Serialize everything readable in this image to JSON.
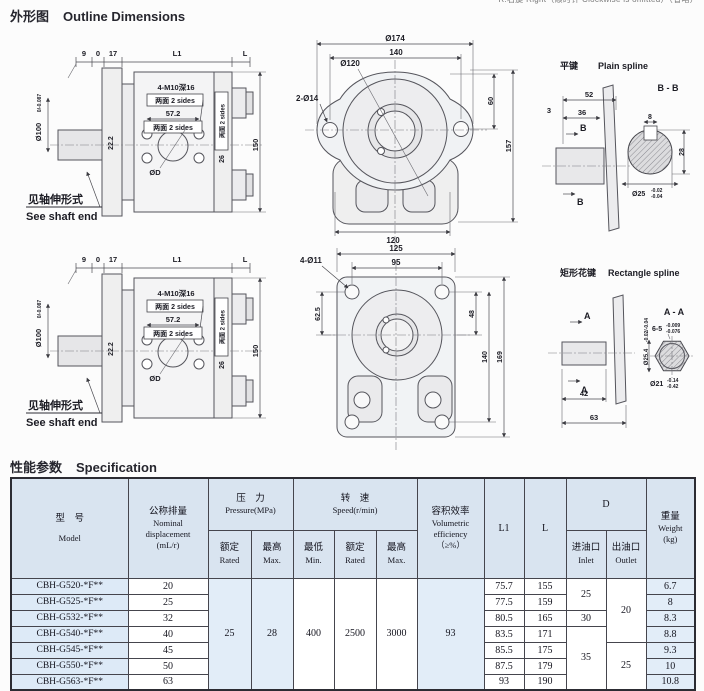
{
  "colors": {
    "page-bg": "#fcfcfc",
    "ink": "#26262e",
    "dim-line": "#4a4a50",
    "table-border": "#45454d",
    "header-bg": "#d9e4f0",
    "cell-blue": "#e2edf8",
    "cell-model": "#ddeaf7",
    "cell-white": "#ffffff"
  },
  "titles": {
    "outline_zh": "外形图",
    "outline_en": "Outline Dimensions",
    "spec_zh": "性能参数",
    "spec_en": "Specification",
    "top_note": "R:右旋 Right（顺时针 Clockwise is omitted）（省略）"
  },
  "side_view": {
    "top_d1": "9",
    "top_d2": "0",
    "top_d3": "17",
    "top_d4": "L1",
    "top_d5": "L",
    "shaft_dia": "Ø100",
    "shaft_tol": "0/-0.087",
    "dim_a": "22.2",
    "tap_note": "4-M10深16",
    "both_sides": "两面 2 sides",
    "dim_b": "57.2",
    "pilot": "ØD",
    "dim_c": "26",
    "dim_d": "150",
    "shaft_note_zh": "见轴伸形式",
    "shaft_note_en": "See shaft end"
  },
  "oval_flange": {
    "dia_outer": "Ø174",
    "dim_140": "140",
    "dia_boss": "Ø120",
    "holes": "2-Ø14",
    "dim_60": "60",
    "dim_157": "157",
    "dim_120": "120"
  },
  "rect_flange": {
    "holes": "4-Ø11",
    "dim_125": "125",
    "dim_95": "95",
    "dim_625": "62.5",
    "dim_48": "48",
    "dim_140": "140",
    "dim_169": "169"
  },
  "plain_spline": {
    "title_zh": "平键",
    "title_en": "Plain spline",
    "section": "B - B",
    "dim_52": "52",
    "dim_3": "3",
    "dim_36": "36",
    "arrow": "B",
    "dim_8": "8",
    "dim_28": "28",
    "dia": "Ø25",
    "tol_u": "-0.02",
    "tol_l": "-0.04"
  },
  "rect_spline": {
    "title_zh": "矩形花键",
    "title_en": "Rectangle spline",
    "section": "A - A",
    "arrow": "A",
    "dim_42": "42",
    "dim_63": "63",
    "spec": "6-5",
    "spec_tol_u": "-0.009",
    "spec_tol_l": "-0.076",
    "dia_major": "Ø25.4",
    "major_tol": "-0.02/-0.04",
    "dia_minor": "Ø21",
    "minor_tol_u": "-0.14",
    "minor_tol_l": "-0.42"
  },
  "spec_table": {
    "header": {
      "model_zh": "型　号",
      "model_en": "Model",
      "disp_zh": "公称排量",
      "disp_en1": "Nominal",
      "disp_en2": "displacement",
      "disp_en3": "(mL/r)",
      "pressure_zh": "压　力",
      "pressure_en": "Pressure(MPa)",
      "speed_zh": "转　速",
      "speed_en": "Speed(r/min)",
      "rated_zh": "额定",
      "rated_en": "Rated",
      "max_zh": "最高",
      "max_en": "Max.",
      "min_zh": "最低",
      "min_en": "Min.",
      "vol_zh": "容积效率",
      "vol_en1": "Volumetric",
      "vol_en2": "efficiency",
      "vol_en3": "（≥%）",
      "l1": "L1",
      "l": "L",
      "d": "D",
      "inlet_zh": "进油口",
      "inlet_en": "Inlet",
      "outlet_zh": "出油口",
      "outlet_en": "Outlet",
      "weight_zh": "重量",
      "weight_en": "Weight",
      "weight_unit": "(kg)"
    },
    "shared": {
      "pressure_rated": "25",
      "pressure_max": "28",
      "speed_min": "400",
      "speed_rated": "2500",
      "speed_max": "3000",
      "vol_eff": "93",
      "inlet_1": "25",
      "inlet_2": "30",
      "inlet_3": "35",
      "outlet_1": "20",
      "outlet_2": "25"
    },
    "rows": [
      {
        "model": "CBH-G520-*F**",
        "disp": "20",
        "l1": "75.7",
        "l": "155",
        "weight": "6.7"
      },
      {
        "model": "CBH-G525-*F**",
        "disp": "25",
        "l1": "77.5",
        "l": "159",
        "weight": "8"
      },
      {
        "model": "CBH-G532-*F**",
        "disp": "32",
        "l1": "80.5",
        "l": "165",
        "weight": "8.3"
      },
      {
        "model": "CBH-G540-*F**",
        "disp": "40",
        "l1": "83.5",
        "l": "171",
        "weight": "8.8"
      },
      {
        "model": "CBH-G545-*F**",
        "disp": "45",
        "l1": "85.5",
        "l": "175",
        "weight": "9.3"
      },
      {
        "model": "CBH-G550-*F**",
        "disp": "50",
        "l1": "87.5",
        "l": "179",
        "weight": "10"
      },
      {
        "model": "CBH-G563-*F**",
        "disp": "63",
        "l1": "93",
        "l": "190",
        "weight": "10.8"
      }
    ]
  }
}
